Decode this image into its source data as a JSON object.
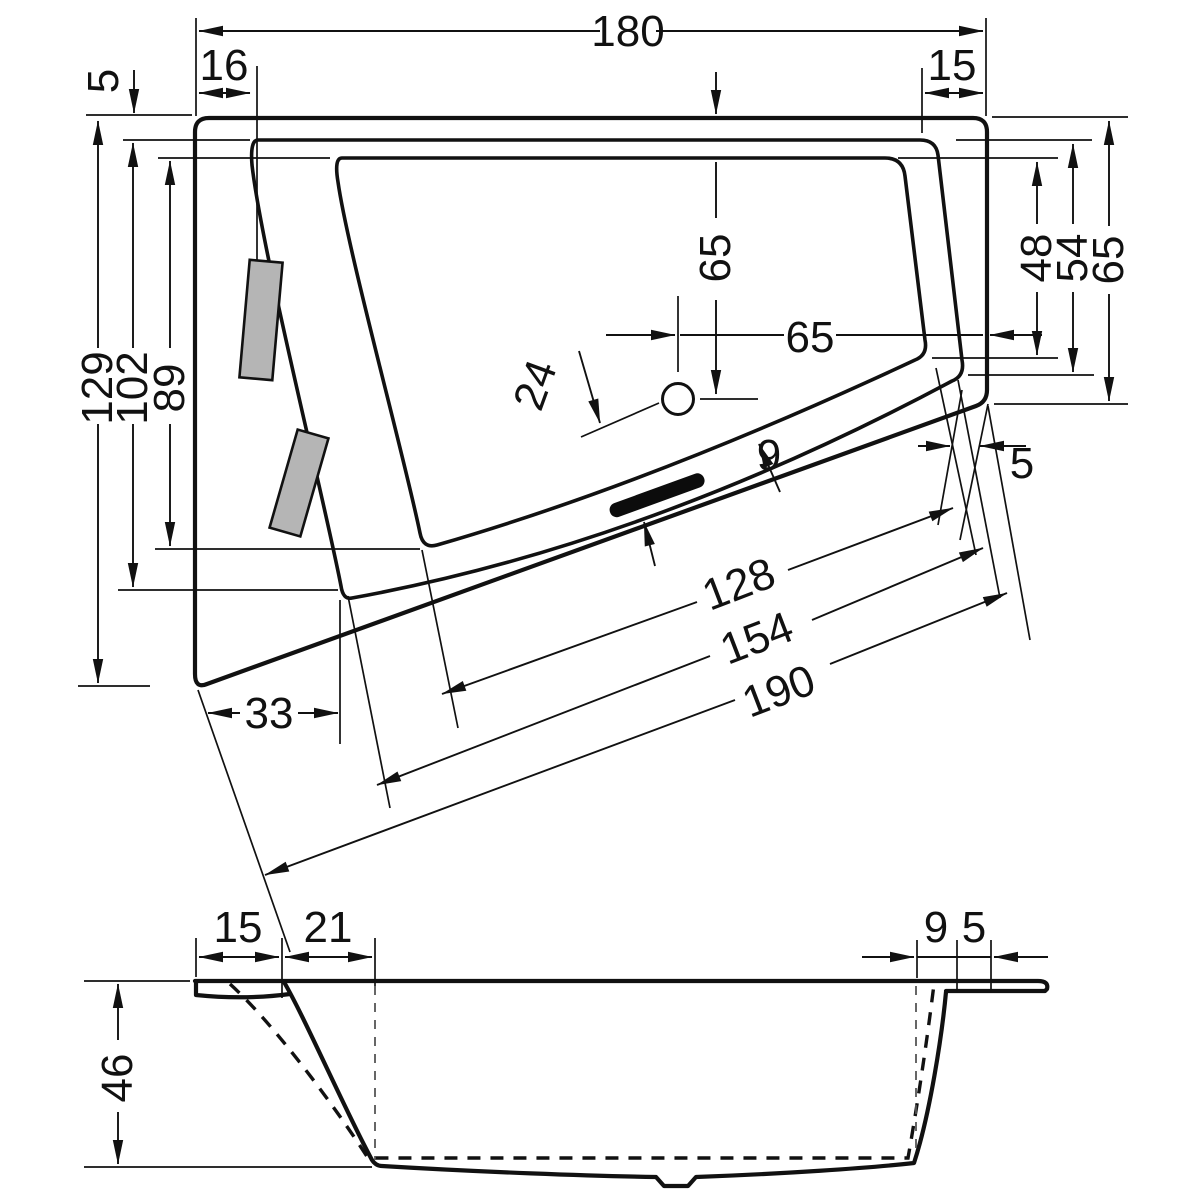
{
  "plan": {
    "width_total": "180",
    "inset_left": "16",
    "inset_right": "15",
    "rim_top": "5",
    "height_left_total": "129",
    "height_left_rim": "102",
    "height_left_basin": "89",
    "drain_top_offset": "65",
    "drain_right_offset": "65",
    "drain_edge_offset": "24",
    "height_right_basin": "48",
    "height_right_rim": "54",
    "height_right_total": "65",
    "rim_bottom_width": "9",
    "rim_bottom_right_width": "5",
    "offset_bottom_left": "33",
    "diag_basin": "128",
    "diag_rim": "154",
    "diag_total": "190"
  },
  "section": {
    "depth": "46",
    "rim_left": "15",
    "slope_left": "21",
    "slope_right": "9",
    "rim_right": "5"
  }
}
